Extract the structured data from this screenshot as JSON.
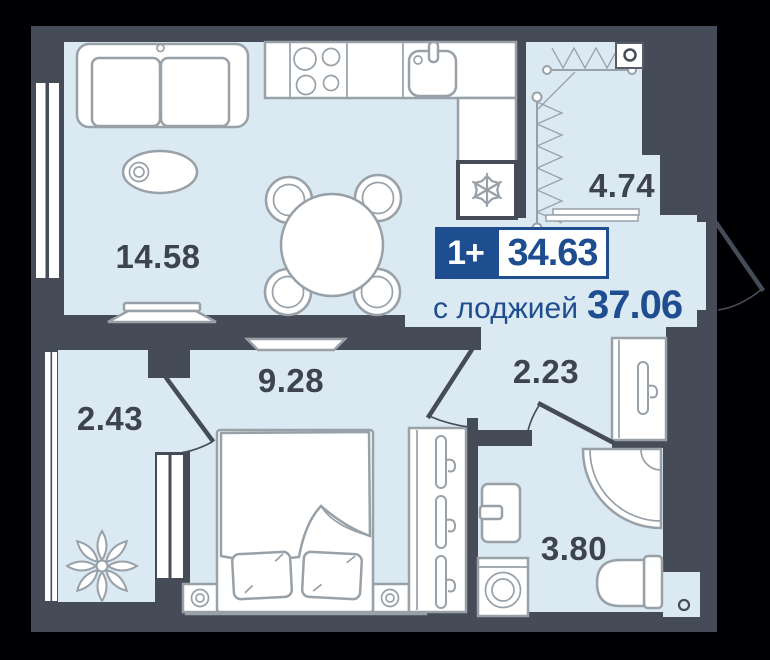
{
  "plan": {
    "badge": {
      "type": "1+",
      "area": "34.63"
    },
    "subtitle": {
      "label": "с лоджией",
      "value": "37.06"
    },
    "rooms": [
      {
        "name": "living-kitchen",
        "area": "14.58"
      },
      {
        "name": "loggia",
        "area": "4.74"
      },
      {
        "name": "balcony",
        "area": "2.43"
      },
      {
        "name": "bedroom",
        "area": "9.28"
      },
      {
        "name": "hallway",
        "area": "2.23"
      },
      {
        "name": "bathroom",
        "area": "3.80"
      }
    ],
    "icons": [
      "snowflake-icon",
      "hanger-icon",
      "plant-icon",
      "drying-rack-icon"
    ],
    "colors": {
      "background": "#000002",
      "wall": "#464b58",
      "floor": "#dbe9f3",
      "accent_blue": "#1e4e90",
      "label": "#3d4350",
      "furniture_stroke": "#98a0a8"
    }
  }
}
